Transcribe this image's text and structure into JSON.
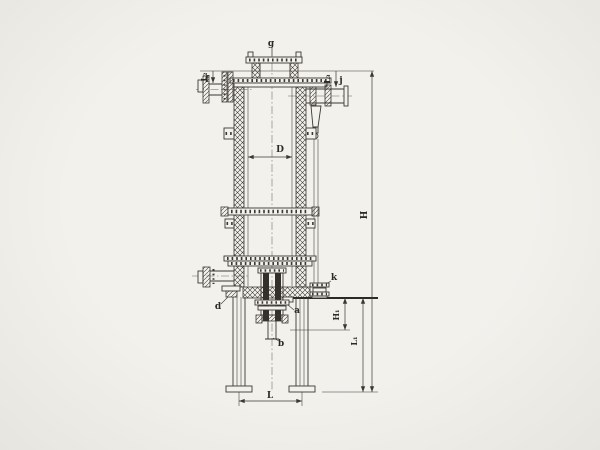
{
  "drawing": {
    "type": "technical engineering drawing",
    "subject": "vertical column vessel with cross-hatched shell walls, flanged nozzles, central bottom discharge assembly and two support legs",
    "nozzle_labels": {
      "top_center": "g",
      "top_left": "f",
      "upper_right": "j",
      "lower_right": "k",
      "lower_left": "d",
      "bottom_side": "a",
      "bottom_center": "b"
    },
    "dimension_labels": {
      "diameter": "D",
      "total_height": "H",
      "bottom_section_height": "H₁",
      "leg_span": "L",
      "lower_height": "L₁",
      "top_left_nozzle_offset": "L₂",
      "top_right_nozzle_offset": "L₃"
    }
  },
  "colors": {
    "background": "#f2f1ec",
    "paper_edge": "#e7e5df",
    "line": "#3b3833",
    "ink": "#2d2a26",
    "dark_fill": "#33302b"
  }
}
